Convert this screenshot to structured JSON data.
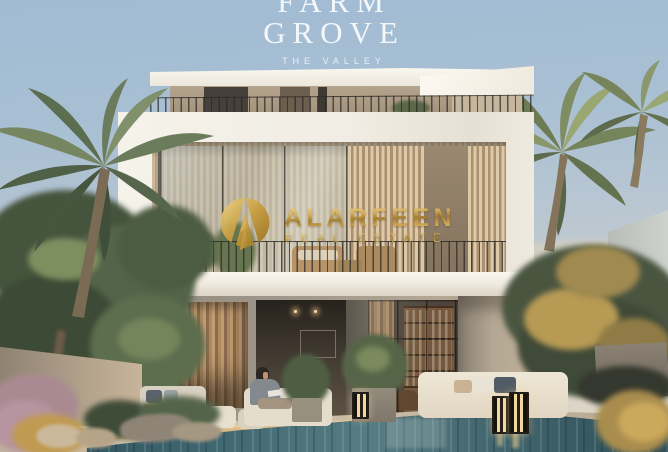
{
  "scene": {
    "subject": "modern-villa-with-pool-dusk-render",
    "palette": {
      "sky_top": "#a3bdd4",
      "sky_horizon": "#d9d5c7",
      "villa_white": "#f2efe7",
      "concrete_grey": "#a29a8c",
      "pool_water": "#3d6570",
      "deck_wood": "#cbbda6",
      "foliage_green": "#53644a",
      "foliage_gold": "#b79a54"
    }
  },
  "project_logo": {
    "line1": "FARM",
    "line2": "GROVE",
    "tagline": "THE VALLEY",
    "color": "#f6f8f9"
  },
  "watermark": {
    "brand": "ALARFEEN",
    "tagline": "REAL ESTATE",
    "gold": "#cfa54e"
  }
}
